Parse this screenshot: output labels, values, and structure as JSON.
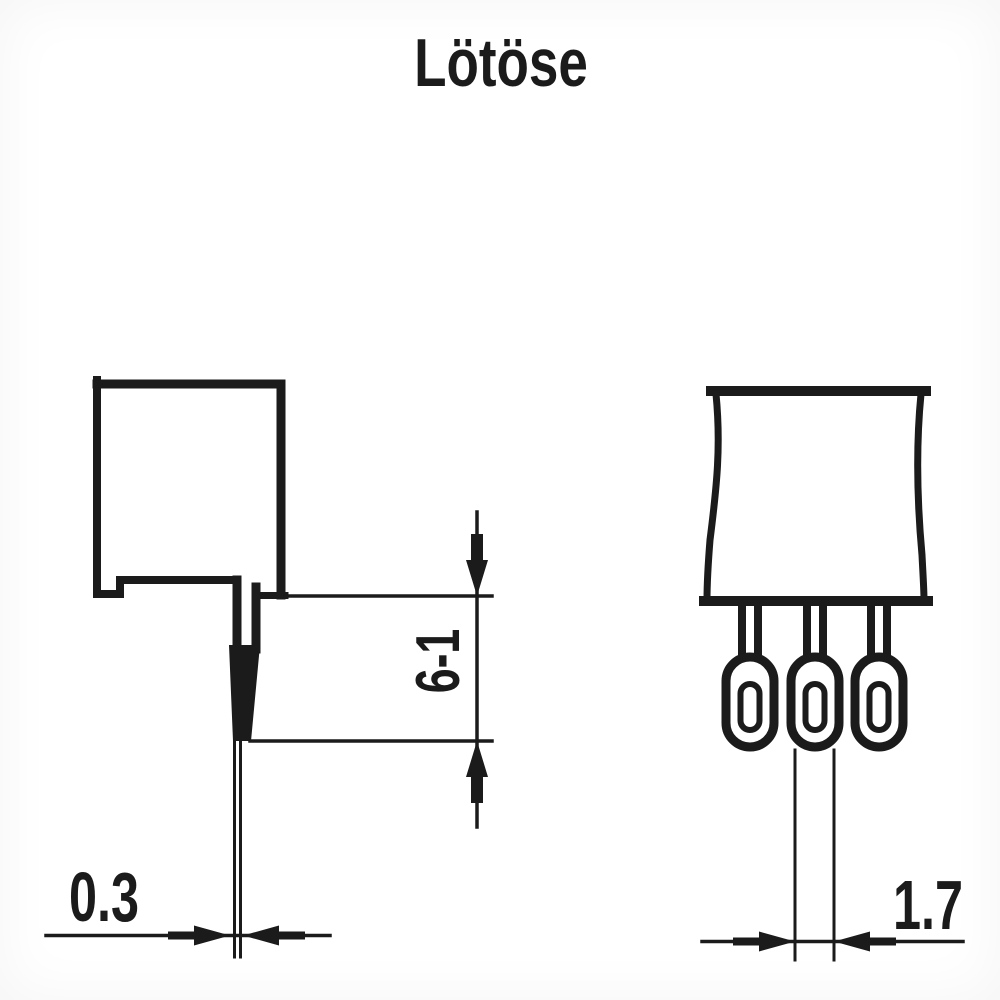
{
  "title": "Lötöse",
  "colors": {
    "ink": "#1b1b1b",
    "paper": "#ffffff"
  },
  "side_view": {
    "description": "side profile of component body with flat solder-lug pin",
    "dimensions": {
      "pin_thickness": "0.3",
      "lug_length": "6-1"
    }
  },
  "front_view": {
    "description": "front of component body with three solder eyelets",
    "lug_count": 3,
    "dimensions": {
      "eyelet_width": "1.7"
    }
  }
}
